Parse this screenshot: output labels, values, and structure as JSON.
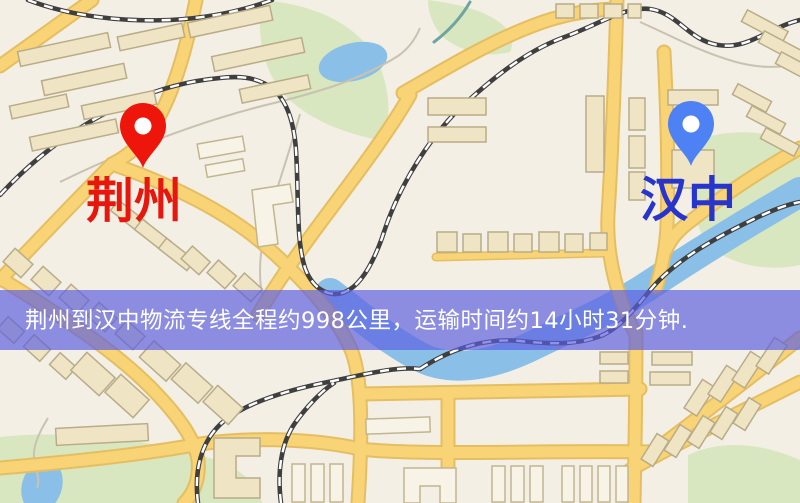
{
  "map": {
    "origin": {
      "name": "荆州"
    },
    "destination": {
      "name": "汉中"
    },
    "banner": {
      "text": "荆州到汉中物流专线全程约998公里，运输时间约14小时31分钟."
    },
    "colors": {
      "land": "#f3efe4",
      "park": "#d9e7c0",
      "water": "#8ac0e8",
      "road": "#f8d476",
      "road_casing": "#e5be62",
      "building": "#efe5c5",
      "railway": "#3f3f3f",
      "origin_pin": "#ee150b",
      "origin_label": "#e8170d",
      "destination_pin": "#4e82f4",
      "destination_label": "#2835cd",
      "banner_bg": "#5b5ee0",
      "banner_text": "#ffffff"
    }
  }
}
